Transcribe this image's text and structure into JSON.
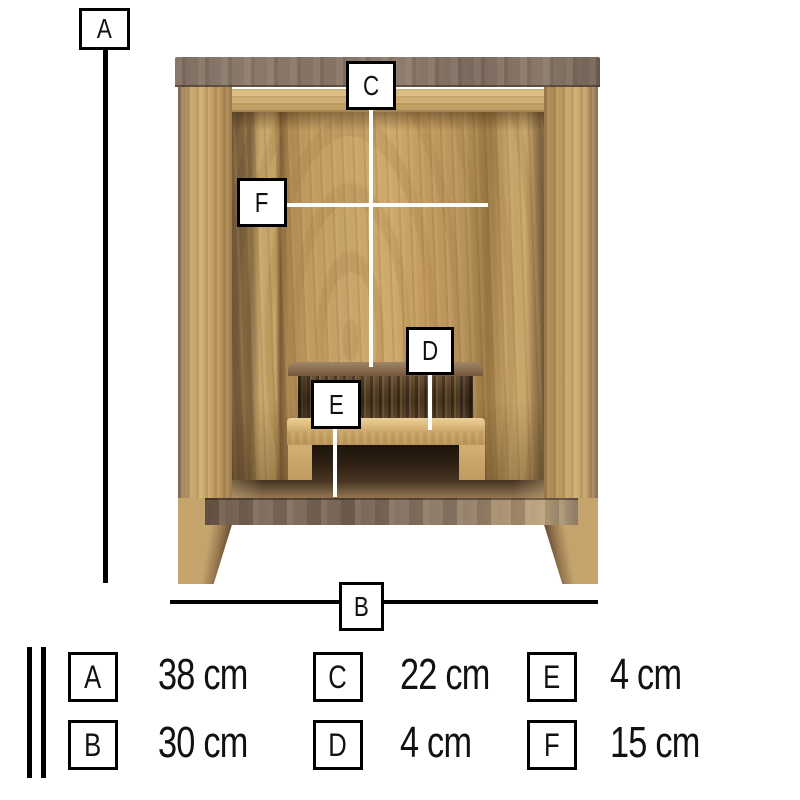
{
  "diagram": {
    "markers": {
      "a": "A",
      "b": "B",
      "c": "C",
      "d": "D",
      "e": "E",
      "f": "F"
    }
  },
  "legend": {
    "entries": [
      {
        "letter": "A",
        "value": "38 cm"
      },
      {
        "letter": "B",
        "value": "30 cm"
      },
      {
        "letter": "C",
        "value": "22 cm"
      },
      {
        "letter": "D",
        "value": "4 cm"
      },
      {
        "letter": "E",
        "value": "4 cm"
      },
      {
        "letter": "F",
        "value": "15 cm"
      }
    ]
  },
  "colors": {
    "background": "#ffffff",
    "walnut_top": "#83705f",
    "oak_frame": "#c9a76b",
    "oak_light": "#dcbf8a",
    "interior_panel": "#c09a5f",
    "step_shadow": "#4a3826",
    "measure_line_black": "#000000",
    "measure_line_white": "#ffffff",
    "box_border": "#000000",
    "box_fill": "#ffffff"
  }
}
